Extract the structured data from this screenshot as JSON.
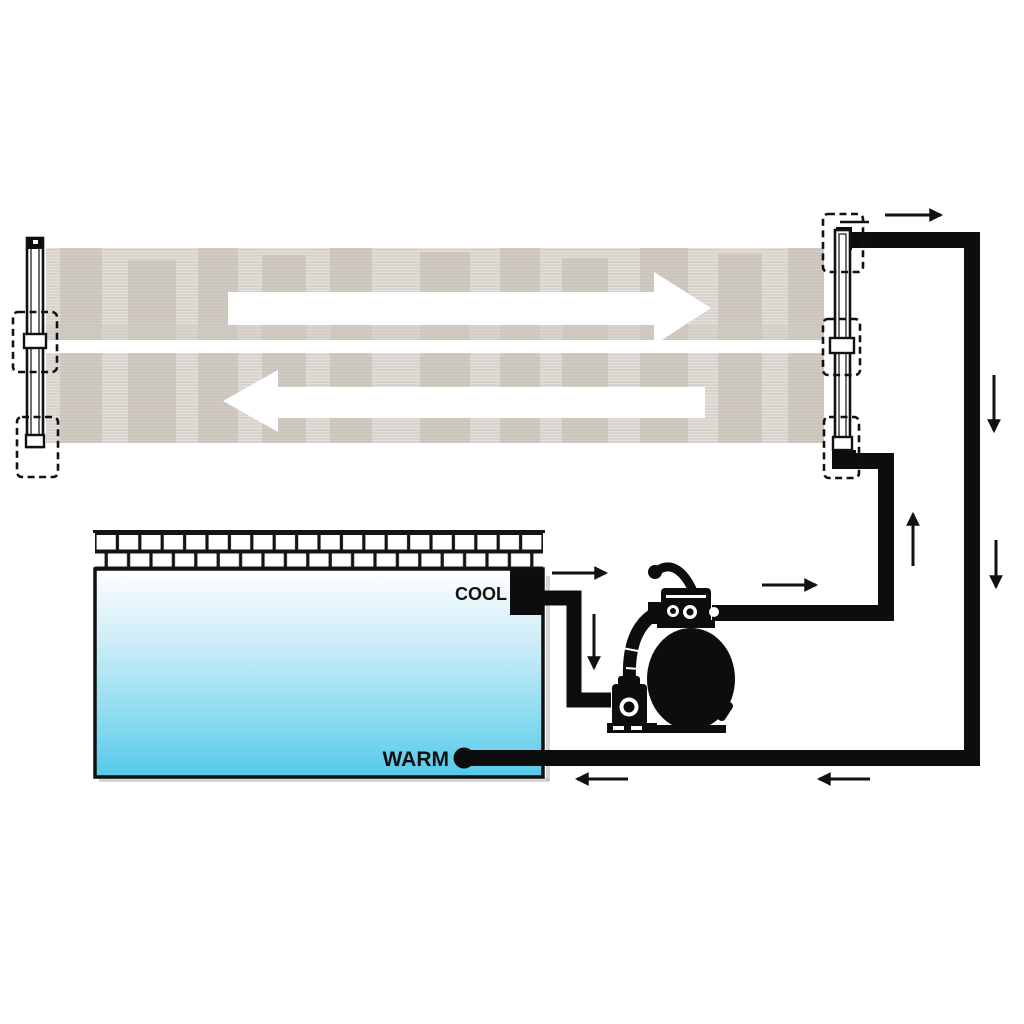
{
  "labels": {
    "cool": "COOL",
    "warm": "WARM"
  },
  "colors": {
    "pipe_black": "#0d0d0d",
    "outline": "#111111",
    "pool_gradient_top": "#ffffff",
    "pool_gradient_mid": "#cdedf7",
    "pool_gradient_bottom": "#55c9ea",
    "mat_base": "#d8d3cc",
    "mat_line": "#e4e1db",
    "mat_blotch": "#c3bbb1",
    "tile_fill": "#ffffff",
    "shadow": "#b5b5b5"
  },
  "components": [
    {
      "id": "solar-collector-mat",
      "desc": "striped solar heater mat"
    },
    {
      "id": "left-manifold-pipe",
      "desc": "collector left header pipe"
    },
    {
      "id": "right-manifold-pipe",
      "desc": "collector right header pipe"
    },
    {
      "id": "mounting-brackets",
      "desc": "dashed mounting bracket boxes",
      "count": 5
    },
    {
      "id": "pool",
      "desc": "swimming pool with tiled coping"
    },
    {
      "id": "skimmer",
      "desc": "cool water outlet",
      "label_ref": "cool"
    },
    {
      "id": "return-fitting",
      "desc": "warm water return",
      "label_ref": "warm"
    },
    {
      "id": "sand-filter-pump",
      "desc": "sand filter with multiport valve and pump"
    }
  ],
  "flow_arrows": [
    {
      "id": "collector-top-flow",
      "direction": "right",
      "style": "large-white"
    },
    {
      "id": "collector-bottom-flow",
      "direction": "left",
      "style": "large-white"
    },
    {
      "id": "collector-outlet",
      "direction": "right",
      "style": "small-black"
    },
    {
      "id": "downpipe-upper",
      "direction": "down",
      "style": "small-black"
    },
    {
      "id": "downpipe-lower",
      "direction": "down",
      "style": "small-black"
    },
    {
      "id": "riser-to-collector",
      "direction": "up",
      "style": "small-black"
    },
    {
      "id": "pump-outlet",
      "direction": "right",
      "style": "small-black"
    },
    {
      "id": "skimmer-outlet",
      "direction": "right",
      "style": "small-black"
    },
    {
      "id": "skimmer-drop",
      "direction": "down",
      "style": "small-black"
    },
    {
      "id": "return-run-outer",
      "direction": "left",
      "style": "small-black"
    },
    {
      "id": "return-run-inner",
      "direction": "left",
      "style": "small-black"
    }
  ]
}
